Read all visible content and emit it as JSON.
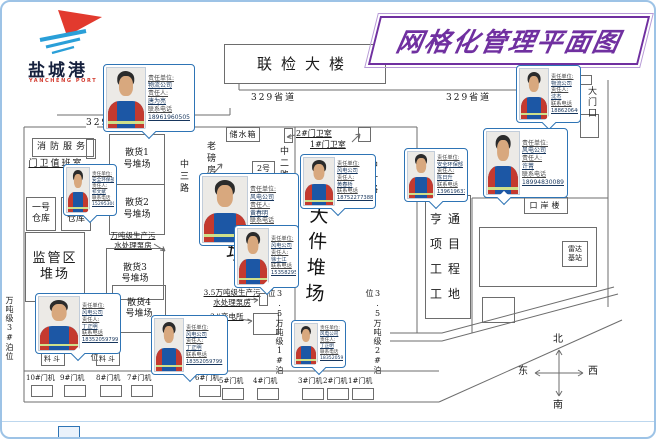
{
  "title": "网格化管理平面图",
  "logo": {
    "name": "盐城港",
    "subtitle": "YANCHENG PORT"
  },
  "road": {
    "provincial": "329省道"
  },
  "roads_vertical": {
    "z1": "中一路",
    "z2": "中二路",
    "z3": "中三路"
  },
  "buildings": {
    "joint_inspection": "联检大楼",
    "fire_service": "消防服务",
    "gate_duty": "门卫值班室",
    "warehouse1": "一号\n仓库",
    "warehouse2": "二号\n仓库",
    "supervision_yard": "监管区\n堆场",
    "bulk1": "散货1\n号堆场",
    "bulk2": "散货2\n号堆场",
    "bulk3": "散货3\n号堆场",
    "bulk4": "散货4\n号堆场",
    "pump_note1": "万吨级生产污\n水处理泵房",
    "pump_note2": "3.5万吨级生产污\n水处理泵房",
    "substation": "3#变电所",
    "water_tank": "储水箱",
    "old_weighbridge": "老磅房",
    "weighbridge2": "2号\n磅房",
    "gatehouse2": "2#门卫室",
    "gatehouse1": "1#门卫室",
    "yard_mid": "堆场",
    "big_cargo_yard": "大件堆场",
    "hengtong": "亨通\n项目\n工程\n工地",
    "port_building": "口岸楼",
    "radar": "雷达\n基站",
    "gate": "大门口",
    "hopper": "料斗"
  },
  "berths": [
    "万吨级3#泊位",
    "2#泊位",
    "3.5万吨级1#泊位",
    "3.5万吨级2#泊位"
  ],
  "cranes": [
    "10#门机",
    "9#门机",
    "8#门机",
    "7#门机",
    "6#门机",
    "5#门机",
    "4#门机",
    "3#门机",
    "2#门机",
    "1#门机"
  ],
  "compass": {
    "north": "北",
    "south": "南",
    "east": "东",
    "west": "西"
  },
  "card_labels": {
    "unit": "责任单位:",
    "person": "责任人:",
    "phone": "联系电话"
  },
  "cards": [
    {
      "unit": "物流公司",
      "person": "唐为亮",
      "phone": "18961960505"
    },
    {
      "unit": "安全环保部",
      "person": "祁文斌",
      "phone": "15295300005"
    },
    {
      "unit": "风电公司",
      "person": "黄春明",
      "phone": "18752277380"
    },
    {
      "unit": "风电公司",
      "person": "徐士江",
      "phone": "15358295555"
    },
    {
      "unit": "风电公司",
      "person": "黄春桥",
      "phone": "18752277388"
    },
    {
      "unit": "安全环保部",
      "person": "陈日升",
      "phone": "13961963735"
    },
    {
      "unit": "物流公司",
      "person": "沈杰",
      "phone": "18862064000"
    },
    {
      "unit": "风电公司",
      "person": "许菁",
      "phone": "18994830089"
    },
    {
      "unit": "风电公司",
      "person": "丁正明",
      "phone": "18352059799"
    },
    {
      "unit": "风电公司",
      "person": "丁正明",
      "phone": "18352059799"
    },
    {
      "unit": "风电公司",
      "person": "丁正明",
      "phone": "18352059799"
    }
  ],
  "colors": {
    "title": "#7030A0",
    "card_border": "#2E74B5",
    "frame": "#9DC3E6",
    "line": "#6d6d6d"
  }
}
